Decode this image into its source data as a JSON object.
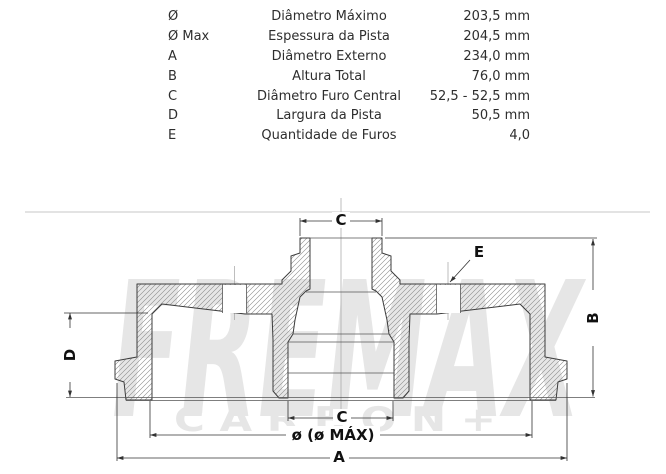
{
  "spec_table": {
    "rows": [
      {
        "symbol": "Ø",
        "description": "Diâmetro Máximo",
        "value": "203,5 mm"
      },
      {
        "symbol": "Ø Max",
        "description": "Espessura da Pista",
        "value": "204,5 mm"
      },
      {
        "symbol": "A",
        "description": "Diâmetro Externo",
        "value": "234,0 mm"
      },
      {
        "symbol": "B",
        "description": "Altura Total",
        "value": "76,0 mm"
      },
      {
        "symbol": "C",
        "description": "Diâmetro Furo Central",
        "value": "52,5 - 52,5 mm"
      },
      {
        "symbol": "D",
        "description": "Largura da Pista",
        "value": "50,5 mm"
      },
      {
        "symbol": "E",
        "description": "Quantidade de Furos",
        "value": "4,0"
      }
    ]
  },
  "watermark": {
    "brand": "FREMAX",
    "sub": "C A R B O N +"
  },
  "drawing": {
    "labels": {
      "c_top": "C",
      "e": "E",
      "b": "B",
      "d": "D",
      "c_bottom": "C",
      "diameter": "ø  (ø MÁX)",
      "a": "A"
    }
  },
  "colors": {
    "outline": "#3c3c3c",
    "dimension": "#333333",
    "watermark": "#e6e6e6",
    "text": "#2e2e2e"
  }
}
